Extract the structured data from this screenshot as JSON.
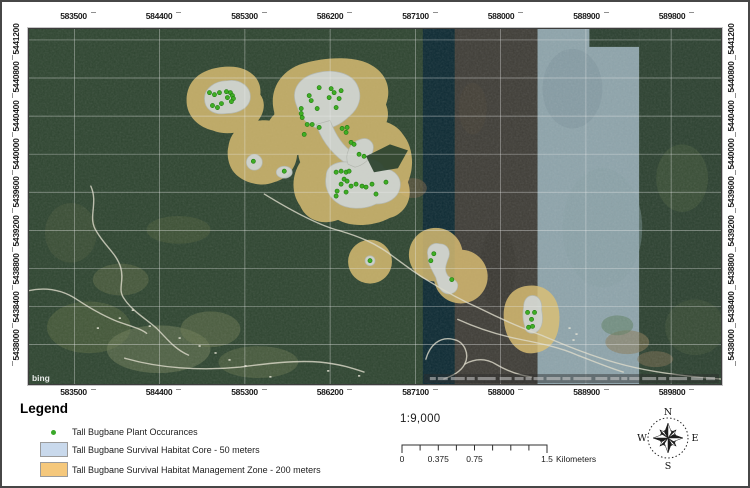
{
  "map": {
    "bing_logo": "bing",
    "grid": {
      "x_labels": [
        "583500",
        "584400",
        "585300",
        "586200",
        "587100",
        "588000",
        "588900",
        "589800"
      ],
      "x_positions": [
        45.5,
        131,
        216.5,
        302,
        387.5,
        473,
        558.5,
        644
      ],
      "y_labels": [
        "5441200",
        "5440800",
        "5440400",
        "5440000",
        "5439600",
        "5439200",
        "5438800",
        "5438400",
        "5438000"
      ],
      "y_positions": [
        11,
        49.3,
        87.6,
        125.9,
        164.2,
        202.5,
        240.8,
        279.1,
        317.4
      ]
    }
  },
  "legend": {
    "title": "Legend",
    "items": [
      {
        "type": "point",
        "label": "Tall Bugbane Plant Occurances",
        "color": "#3aa829"
      },
      {
        "type": "fill",
        "label": "Tall Bugbane Survival Habitat Core - 50 meters",
        "color": "#c9d9ec"
      },
      {
        "type": "fill",
        "label": "Tall Bugbane Survival Habitat Management Zone - 200 meters",
        "color": "#f5c87c"
      }
    ]
  },
  "scale": {
    "ratio_text": "1:9,000",
    "bar_labels": [
      {
        "text": "0",
        "f": 0
      },
      {
        "text": "0.375",
        "f": 0.25
      },
      {
        "text": "0.75",
        "f": 0.5
      },
      {
        "text": "1.5",
        "f": 1
      }
    ],
    "unit": "Kilometers"
  },
  "compass": {
    "n": "N",
    "e": "E",
    "s": "S",
    "w": "W"
  },
  "map_data": {
    "colors": {
      "forest": "#2e4530",
      "management_zone": "#dcbf74",
      "core_zone": "#cfd4d2",
      "core_stroke": "#b4bab6",
      "plant_point": "#3fae24",
      "plant_point_stroke": "#1f7a10",
      "road": "#dddbcb",
      "grid": "#ececec"
    },
    "bands": [
      {
        "x": 0,
        "y": 0,
        "w": 694,
        "h": 357,
        "f": "#2e4530",
        "o": 1
      },
      {
        "x": 395,
        "y": 0,
        "w": 32,
        "h": 357,
        "f": "#0d2a33",
        "o": 1
      },
      {
        "x": 427,
        "y": 0,
        "w": 83,
        "h": 357,
        "f": "#3f3d37",
        "o": 1
      },
      {
        "x": 510,
        "y": 0,
        "w": 102,
        "h": 357,
        "f": "#8ea4ab",
        "o": 1
      },
      {
        "x": 612,
        "y": 0,
        "w": 82,
        "h": 357,
        "f": "#2c4130",
        "o": 1
      },
      {
        "x": 562,
        "y": 0,
        "w": 50,
        "h": 18,
        "f": "#2b4030",
        "o": 1
      }
    ],
    "patches": [
      {
        "cx": 60,
        "cy": 300,
        "rx": 42,
        "ry": 26,
        "fill": "#55663f",
        "o": 0.55
      },
      {
        "cx": 130,
        "cy": 322,
        "rx": 52,
        "ry": 24,
        "fill": "#72805a",
        "o": 0.5
      },
      {
        "cx": 182,
        "cy": 302,
        "rx": 30,
        "ry": 18,
        "fill": "#68764e",
        "o": 0.5
      },
      {
        "cx": 92,
        "cy": 252,
        "rx": 28,
        "ry": 16,
        "fill": "#5d6b45",
        "o": 0.5
      },
      {
        "cx": 42,
        "cy": 205,
        "rx": 26,
        "ry": 30,
        "fill": "#49583b",
        "o": 0.45
      },
      {
        "cx": 150,
        "cy": 202,
        "rx": 32,
        "ry": 14,
        "fill": "#55653f",
        "o": 0.4
      },
      {
        "cx": 230,
        "cy": 335,
        "rx": 40,
        "ry": 16,
        "fill": "#66744d",
        "o": 0.45
      },
      {
        "cx": 385,
        "cy": 160,
        "rx": 14,
        "ry": 10,
        "fill": "#6b5a42",
        "o": 0.6
      },
      {
        "cx": 445,
        "cy": 80,
        "rx": 14,
        "ry": 26,
        "fill": "#4a4338",
        "o": 0.5
      },
      {
        "cx": 470,
        "cy": 240,
        "rx": 18,
        "ry": 40,
        "fill": "#37352f",
        "o": 0.5
      },
      {
        "cx": 600,
        "cy": 315,
        "rx": 22,
        "ry": 12,
        "fill": "#8b7a58",
        "o": 0.55
      },
      {
        "cx": 628,
        "cy": 332,
        "rx": 18,
        "ry": 8,
        "fill": "#7d7052",
        "o": 0.5
      },
      {
        "cx": 590,
        "cy": 298,
        "rx": 16,
        "ry": 10,
        "fill": "#5f7f63",
        "o": 0.55
      },
      {
        "cx": 655,
        "cy": 150,
        "rx": 26,
        "ry": 34,
        "fill": "#465c3c",
        "o": 0.5
      },
      {
        "cx": 668,
        "cy": 300,
        "rx": 30,
        "ry": 28,
        "fill": "#44583c",
        "o": 0.45
      },
      {
        "cx": 545,
        "cy": 60,
        "rx": 30,
        "ry": 40,
        "fill": "#7e949d",
        "o": 0.5
      },
      {
        "cx": 575,
        "cy": 200,
        "rx": 40,
        "ry": 60,
        "fill": "#87a0a6",
        "o": 0.4
      }
    ],
    "zones_management": [
      {
        "d": "M158,72 C158,52 172,40 196,38 C218,36 234,48 232,66 C238,74 236,86 228,94 C218,104 198,108 184,102 C168,98 158,86 158,72 Z"
      },
      {
        "d": "M246,84 C240,62 252,42 274,35 C296,28 330,26 346,38 C358,46 364,60 358,76 C364,90 356,104 342,112 C328,120 306,122 290,116 C270,120 252,112 246,98 Z"
      },
      {
        "cx": 262,
        "cy": 104,
        "r": 24
      },
      {
        "d": "M200,118 C202,102 216,92 232,92 C250,90 266,102 268,118 C272,134 262,150 246,154 C232,160 212,154 204,142 C200,136 198,126 200,118 Z"
      },
      {
        "d": "M277,106 C290,94 312,90 330,96 C346,88 366,92 375,106 C385,118 387,138 380,154 C386,170 377,186 362,190 C347,198 324,200 310,192 C294,198 278,192 272,178 C262,164 264,146 272,134 C268,124 270,112 277,106 Z"
      },
      {
        "cx": 342,
        "cy": 234,
        "r": 22
      },
      {
        "cx": 408,
        "cy": 227,
        "r": 27
      },
      {
        "cx": 433,
        "cy": 249,
        "r": 27
      },
      {
        "d": "M476,288 C476,268 488,258 504,258 C520,258 532,270 532,290 C532,310 524,324 506,326 C490,328 476,312 476,288 Z"
      }
    ],
    "zones_core": [
      {
        "d": "M176,70 C176,60 186,52 199,52 C212,50 222,58 222,68 C222,78 212,85 198,85 C184,87 176,80 176,70 Z"
      },
      {
        "d": "M268,76 C262,60 272,48 289,44 C305,40 323,44 329,56 C335,68 331,80 321,88 C313,96 301,102 291,100 C279,98 272,88 268,76 Z"
      },
      {
        "d": "M288,96 L302,92 C308,108 316,120 328,126 L322,138 C306,128 294,114 288,96 Z"
      },
      {
        "d": "M298,148 C298,138 308,132 322,134 C336,128 352,130 356,140 C368,142 374,150 372,160 C370,170 360,176 348,176 C336,182 318,182 308,174 C300,168 296,158 298,148 Z"
      },
      {
        "d": "M320,136 C316,126 322,114 332,111 C340,108 347,114 345,122 C343,131 335,137 327,139 Z"
      },
      {
        "cx": 226,
        "cy": 134,
        "r": 8
      },
      {
        "cx": 256,
        "cy": 144,
        "rx": 8,
        "ry": 6
      },
      {
        "cx": 342,
        "cy": 233,
        "r": 5
      },
      {
        "d": "M400,228 C398,220 404,214 412,216 C420,216 424,224 420,232 C418,238 416,242 420,248 C424,252 430,252 430,258 C430,264 424,268 418,266 C412,264 410,258 408,250 C404,242 400,236 400,228 Z"
      },
      {
        "d": "M496,280 C496,272 500,268 505,268 C511,268 515,274 514,282 C516,292 515,300 510,304 C505,308 497,306 497,298 C495,292 495,286 496,280 Z"
      }
    ],
    "forest_notches": [
      {
        "d": "M338,128 L362,116 L380,122 L370,140 L346,144 Z"
      }
    ],
    "roads": [
      "M236,166 C262,182 292,198 312,203 C332,209 346,215 360,225 C374,235 386,245 400,253 C416,263 434,273 452,281 C472,291 492,300 514,308 C538,318 564,329 590,336 C618,344 652,349 694,352",
      "M62,158 C70,176 58,190 68,204 C76,218 88,226 92,240 C96,254 88,262 96,272 C104,284 118,292 128,301 C138,311 146,322 160,328",
      "M0,263 C20,259 36,264 48,272 C60,280 74,288 86,293 C98,298 110,300 118,306",
      "M96,331 C130,341 172,344 212,340 C242,336 268,333 292,335 C312,337 324,341 336,345",
      "M398,332 C402,318 412,309 425,312 C437,314 442,327 437,337 C433,345 424,349 416,352",
      "M430,292 C452,302 472,308 492,312 C512,316 532,320 550,328 C566,334 580,340 596,345",
      "M437,337 C448,331 458,331 468,337 C478,343 490,348 504,350"
    ],
    "specks": [
      [
        150,
        310
      ],
      [
        170,
        318
      ],
      [
        186,
        325
      ],
      [
        200,
        332
      ],
      [
        120,
        298
      ],
      [
        216,
        338
      ],
      [
        241,
        349
      ],
      [
        299,
        343
      ],
      [
        330,
        348
      ],
      [
        90,
        290
      ],
      [
        541,
        300
      ],
      [
        548,
        306
      ],
      [
        545,
        312
      ],
      [
        103,
        282
      ],
      [
        68,
        300
      ]
    ],
    "plant_points": [
      [
        181,
        64
      ],
      [
        186,
        66
      ],
      [
        191,
        64
      ],
      [
        198,
        63
      ],
      [
        202,
        64
      ],
      [
        204,
        67
      ],
      [
        199,
        69
      ],
      [
        205,
        70
      ],
      [
        193,
        75
      ],
      [
        184,
        77
      ],
      [
        189,
        79
      ],
      [
        203,
        73
      ],
      [
        291,
        59
      ],
      [
        303,
        60
      ],
      [
        306,
        64
      ],
      [
        313,
        62
      ],
      [
        301,
        69
      ],
      [
        281,
        67
      ],
      [
        283,
        72
      ],
      [
        311,
        70
      ],
      [
        273,
        80
      ],
      [
        289,
        80
      ],
      [
        308,
        79
      ],
      [
        273,
        85
      ],
      [
        274,
        89
      ],
      [
        279,
        96
      ],
      [
        284,
        96
      ],
      [
        276,
        106
      ],
      [
        291,
        99
      ],
      [
        314,
        100
      ],
      [
        319,
        99
      ],
      [
        318,
        104
      ],
      [
        323,
        114
      ],
      [
        326,
        116
      ],
      [
        331,
        126
      ],
      [
        336,
        128
      ],
      [
        308,
        144
      ],
      [
        313,
        143
      ],
      [
        318,
        144
      ],
      [
        321,
        143
      ],
      [
        316,
        151
      ],
      [
        319,
        153
      ],
      [
        313,
        156
      ],
      [
        323,
        158
      ],
      [
        328,
        156
      ],
      [
        334,
        158
      ],
      [
        338,
        159
      ],
      [
        344,
        156
      ],
      [
        358,
        154
      ],
      [
        309,
        163
      ],
      [
        318,
        164
      ],
      [
        308,
        168
      ],
      [
        348,
        166
      ],
      [
        225,
        133
      ],
      [
        256,
        143
      ],
      [
        342,
        233
      ],
      [
        406,
        226
      ],
      [
        403,
        233
      ],
      [
        424,
        252
      ],
      [
        500,
        285
      ],
      [
        507,
        285
      ],
      [
        504,
        292
      ],
      [
        501,
        300
      ],
      [
        505,
        299
      ]
    ]
  }
}
